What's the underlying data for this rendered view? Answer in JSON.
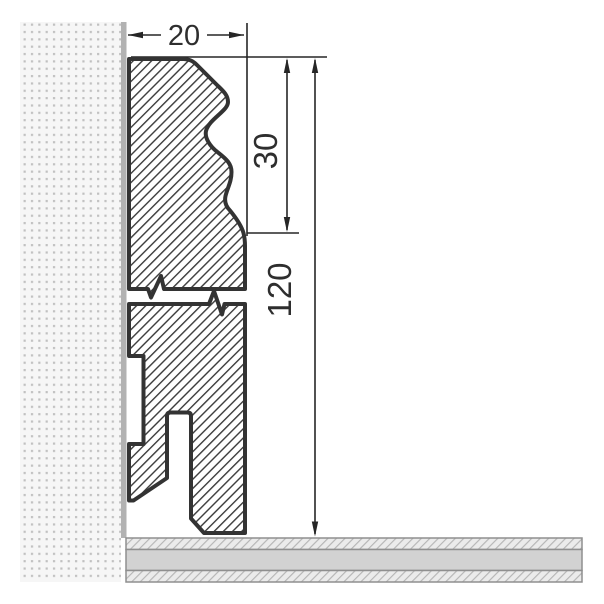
{
  "drawing": {
    "kind": "skirting-board-cross-section",
    "dimensions": {
      "width": {
        "value": "20"
      },
      "upper_profile_height": {
        "value": "30"
      },
      "total_height": {
        "value": "120"
      }
    },
    "colors": {
      "profile_outline": "#333333",
      "profile_hatch": "#3a3a3a",
      "dimension_lines": "#262626",
      "wall_dots": "#c0c0c0",
      "wall_surface_strip": "#b2b2b2",
      "floor_middle_fill": "#d2d2d2",
      "floor_hatch_fill": "#ebebeb",
      "floor_hatch_lines": "#b3b3b3",
      "floor_borders": "#8f8f8f"
    }
  }
}
